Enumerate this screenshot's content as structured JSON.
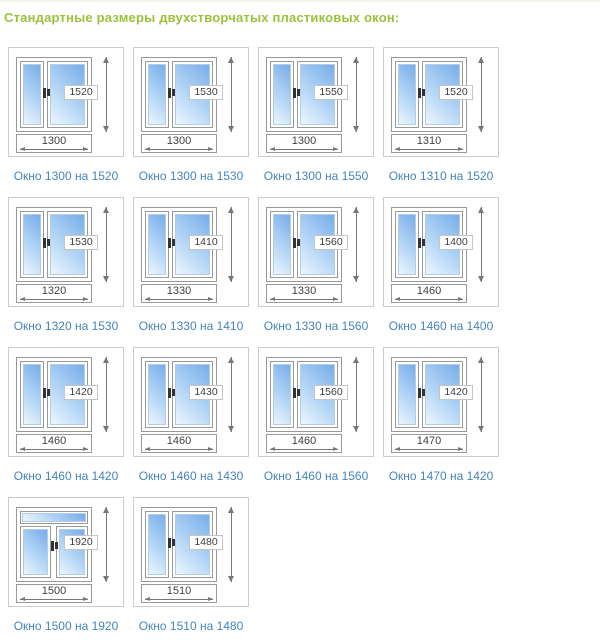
{
  "page": {
    "title": "Стандартные размеры двухстворчатых пластиковых окон:"
  },
  "colors": {
    "title_green": "#9cc13c",
    "caption_blue": "#4484bc",
    "glass_light": "#edf6fe",
    "glass_dark": "#78ade9",
    "dimension_text": "#3f3f3f"
  },
  "windows": [
    {
      "width": "1300",
      "height": "1520",
      "caption": "Окно 1300 на 1520",
      "type": "standard"
    },
    {
      "width": "1300",
      "height": "1530",
      "caption": "Окно 1300 на 1530",
      "type": "standard"
    },
    {
      "width": "1300",
      "height": "1550",
      "caption": "Окно 1300 на 1550",
      "type": "standard"
    },
    {
      "width": "1310",
      "height": "1520",
      "caption": "Окно 1310 на 1520",
      "type": "standard"
    },
    {
      "width": "1320",
      "height": "1530",
      "caption": "Окно 1320 на 1530",
      "type": "standard"
    },
    {
      "width": "1330",
      "height": "1410",
      "caption": "Окно 1330 на 1410",
      "type": "standard"
    },
    {
      "width": "1330",
      "height": "1560",
      "caption": "Окно 1330 на 1560",
      "type": "standard"
    },
    {
      "width": "1460",
      "height": "1400",
      "caption": "Окно 1460 на 1400",
      "type": "standard"
    },
    {
      "width": "1460",
      "height": "1420",
      "caption": "Окно 1460 на 1420",
      "type": "standard"
    },
    {
      "width": "1460",
      "height": "1430",
      "caption": "Окно 1460 на 1430",
      "type": "standard"
    },
    {
      "width": "1460",
      "height": "1560",
      "caption": "Окно 1460 на 1560",
      "type": "standard"
    },
    {
      "width": "1470",
      "height": "1420",
      "caption": "Окно 1470 на 1420",
      "type": "standard"
    },
    {
      "width": "1500",
      "height": "1920",
      "caption": "Окно 1500 на 1920",
      "type": "transom"
    },
    {
      "width": "1510",
      "height": "1480",
      "caption": "Окно 1510 на 1480",
      "type": "standard"
    }
  ]
}
